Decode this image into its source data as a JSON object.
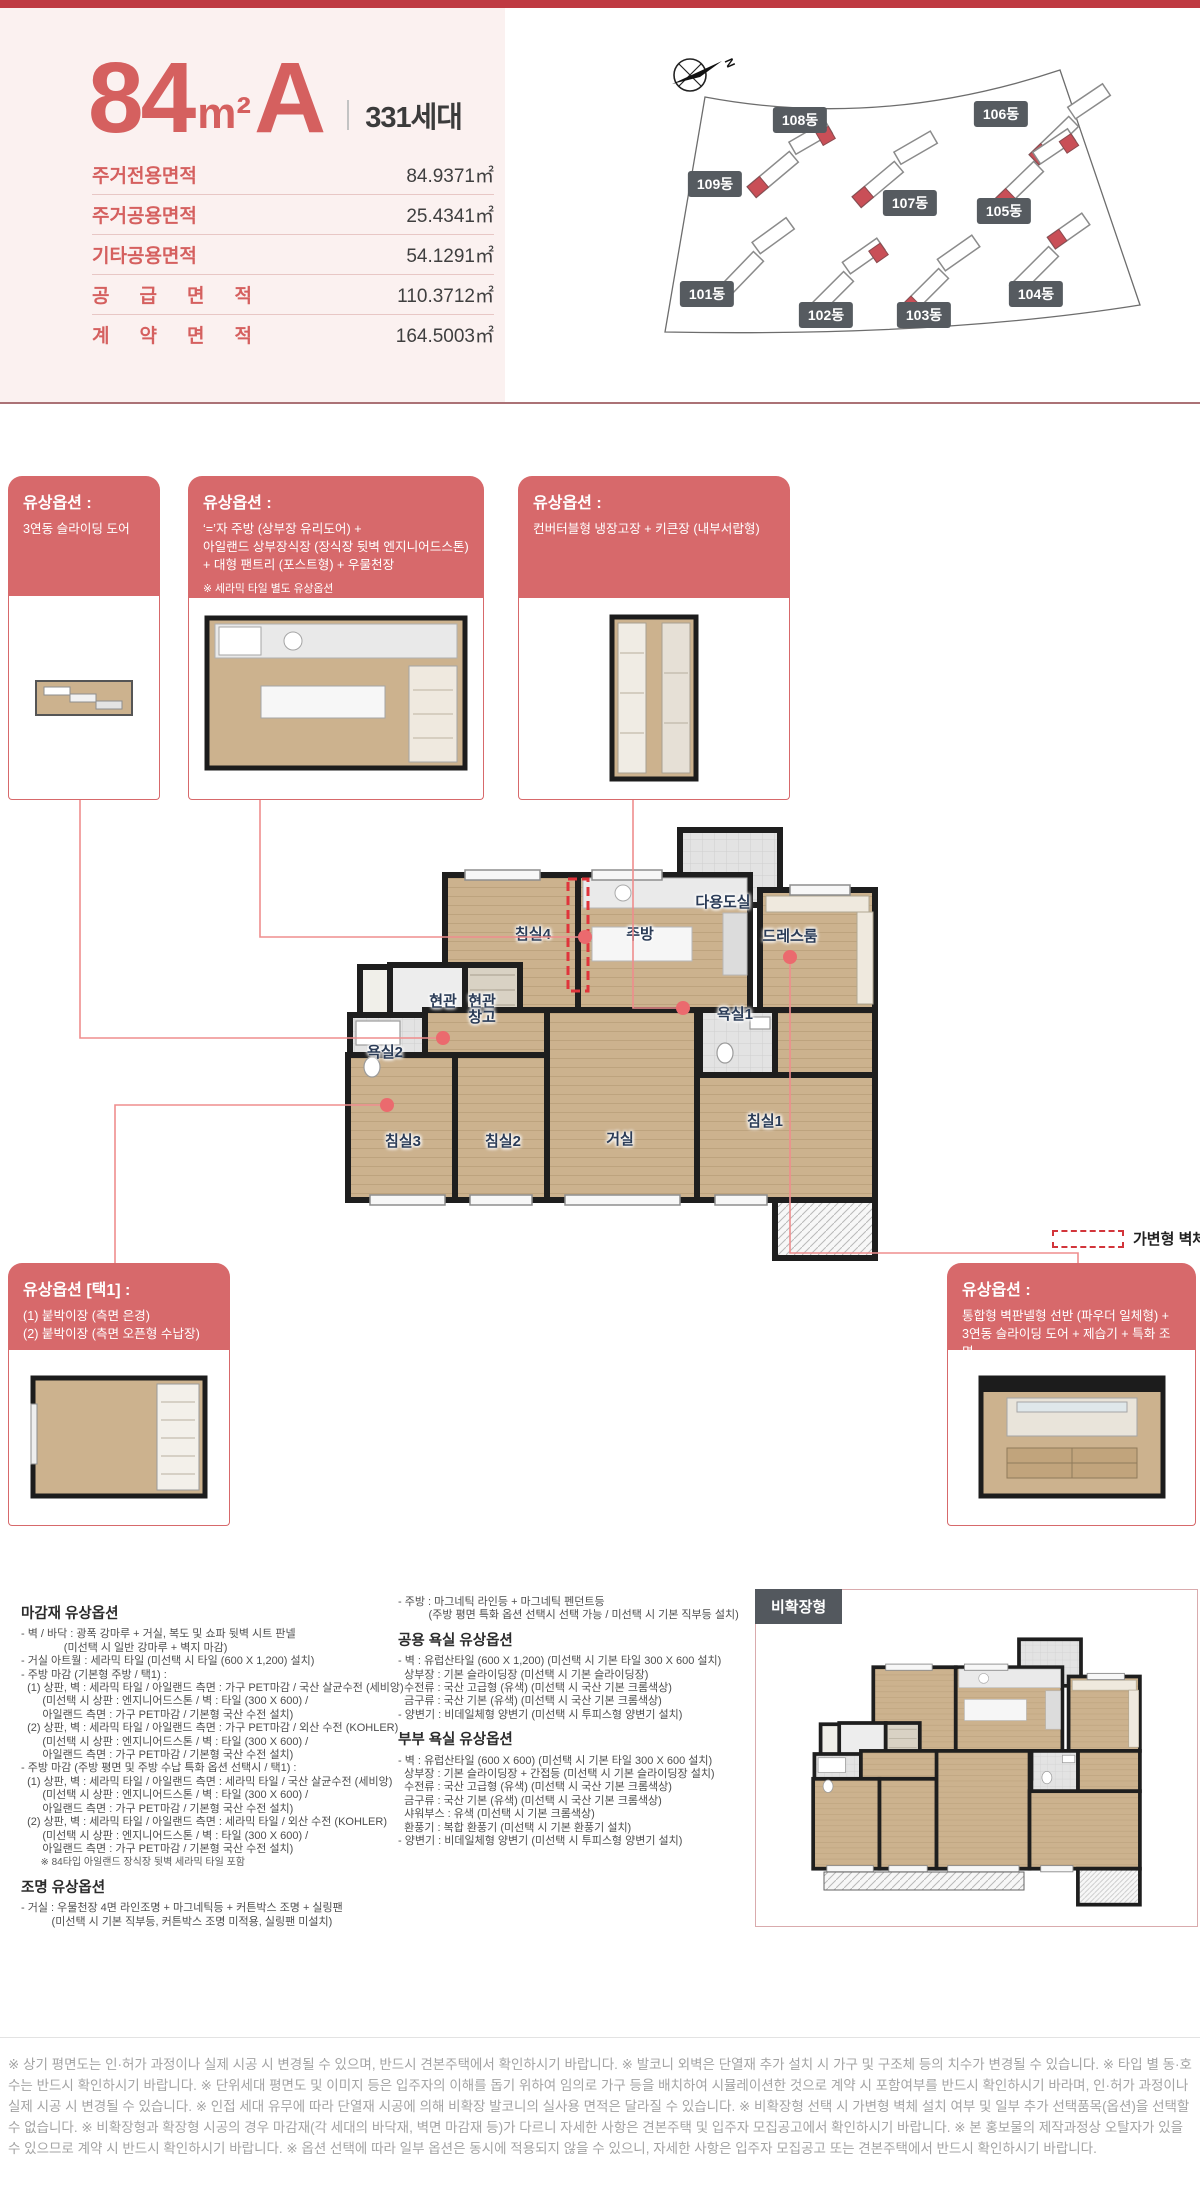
{
  "page": {
    "top_bar_color": "#bf3a42",
    "panel_bg": "#fbf1f0",
    "accent": "#d7696b"
  },
  "header": {
    "type_number": "84",
    "type_unit": "m²",
    "type_variant": "A",
    "households": "331세대",
    "area_rows": [
      {
        "label": "주거전용면적",
        "value": "84.9371㎡"
      },
      {
        "label": "주거공용면적",
        "value": "25.4341㎡"
      },
      {
        "label": "기타공용면적",
        "value": "54.1291㎡"
      },
      {
        "label": "공 급 면 적",
        "value": "110.3712㎡"
      },
      {
        "label": "계 약 면 적",
        "value": "164.5003㎡"
      }
    ]
  },
  "site_plan": {
    "compass_label": "N",
    "building_labels": [
      {
        "label": "108동",
        "x": 800,
        "y": 120
      },
      {
        "label": "106동",
        "x": 1001,
        "y": 114
      },
      {
        "label": "109동",
        "x": 715,
        "y": 184
      },
      {
        "label": "107동",
        "x": 910,
        "y": 203
      },
      {
        "label": "105동",
        "x": 1004,
        "y": 211
      },
      {
        "label": "101동",
        "x": 707,
        "y": 294
      },
      {
        "label": "102동",
        "x": 826,
        "y": 315
      },
      {
        "label": "103동",
        "x": 924,
        "y": 315
      },
      {
        "label": "104동",
        "x": 1036,
        "y": 294
      }
    ]
  },
  "callouts": {
    "box1": {
      "title": "유상옵션 :",
      "lines": [
        "3연동 슬라이딩 도어"
      ]
    },
    "box2": {
      "title": "유상옵션 :",
      "lines": [
        "‘=’자 주방 (상부장 유리도어) +",
        "아일랜드 상부장식장 (장식장 뒷벽 엔지니어드스톤)",
        "+ 대형 팬트리 (포스트형) + 우물천장"
      ],
      "note": "※ 세라믹 타일 별도 유상옵션"
    },
    "box3": {
      "title": "유상옵션 :",
      "lines": [
        "컨버터블형 냉장고장 + 키큰장 (내부서랍형)"
      ]
    },
    "bottom_left": {
      "title": "유상옵션 [택1] :",
      "lines": [
        "(1) 붙박이장 (측면 은경)",
        "(2) 붙박이장 (측면 오픈형 수납장)"
      ]
    },
    "bottom_right": {
      "title": "유상옵션 :",
      "lines": [
        "통합형 벽판넬형 선반 (파우더 일체형) +",
        "3연동 슬라이딩 도어 + 제습기 + 특화 조명"
      ]
    }
  },
  "floor_plan": {
    "legend_label": "가변형 벽체",
    "room_labels": [
      {
        "label": "침실4",
        "x": 533,
        "y": 935
      },
      {
        "label": "주방",
        "x": 640,
        "y": 935
      },
      {
        "label": "다용도실",
        "x": 723,
        "y": 903
      },
      {
        "label": "드레스룸",
        "x": 790,
        "y": 937
      },
      {
        "label": "현관",
        "x": 443,
        "y": 1002
      },
      {
        "label": "현관\n창고",
        "x": 482,
        "y": 1010
      },
      {
        "label": "욕실1",
        "x": 735,
        "y": 1015
      },
      {
        "label": "욕실2",
        "x": 385,
        "y": 1053
      },
      {
        "label": "침실3",
        "x": 403,
        "y": 1142
      },
      {
        "label": "침실2",
        "x": 503,
        "y": 1142
      },
      {
        "label": "거실",
        "x": 620,
        "y": 1140
      },
      {
        "label": "침실1",
        "x": 765,
        "y": 1122
      }
    ]
  },
  "non_expanded": {
    "badge": "비확장형"
  },
  "options": {
    "left": [
      {
        "cls": "h",
        "text": "마감재 유상옵션"
      },
      {
        "cls": "l",
        "text": "- 벽 / 바닥 : 광폭 강마루 + 거실, 복도 및 쇼파 뒷벽 시트 판넬"
      },
      {
        "cls": "l",
        "text": "              (미선택 시 일반 강마루 + 벽지 마감)"
      },
      {
        "cls": "l",
        "text": "- 거실 아트월 : 세라믹 타일 (미선택 시 타일 (600 X 1,200) 설치)"
      },
      {
        "cls": "l",
        "text": "- 주방 마감 (기본형 주방 / 택1) :"
      },
      {
        "cls": "l",
        "text": "  (1) 상판, 벽 : 세라믹 타일 / 아일랜드 측면 : 가구 PET마감 / 국산 살균수전 (세비앙)"
      },
      {
        "cls": "l",
        "text": "       (미선택 시 상판 : 엔지니어드스톤 / 벽 : 타일 (300 X 600) /"
      },
      {
        "cls": "l",
        "text": "       아일랜드 측면 : 가구 PET마감 / 기본형 국산 수전 설치)"
      },
      {
        "cls": "l",
        "text": "  (2) 상판, 벽 : 세라믹 타일 / 아일랜드 측면 : 가구 PET마감 / 외산 수전 (KOHLER)"
      },
      {
        "cls": "l",
        "text": "       (미선택 시 상판 : 엔지니어드스톤 / 벽 : 타일 (300 X 600) /"
      },
      {
        "cls": "l",
        "text": "       아일랜드 측면 : 가구 PET마감 / 기본형 국산 수전 설치)"
      },
      {
        "cls": "l",
        "text": "- 주방 마감 (주방 평면 및 주방 수납 특화 옵션 선택시 / 택1) :"
      },
      {
        "cls": "l",
        "text": "  (1) 상판, 벽 : 세라믹 타일 / 아일랜드 측면 : 세라믹 타일 / 국산 살균수전 (세비앙)"
      },
      {
        "cls": "l",
        "text": "       (미선택 시 상판 : 엔지니어드스톤 / 벽 : 타일 (300 X 600) /"
      },
      {
        "cls": "l",
        "text": "       아일랜드 측면 : 가구 PET마감 / 기본형 국산 수전 설치)"
      },
      {
        "cls": "l",
        "text": "  (2) 상판, 벽 : 세라믹 타일 / 아일랜드 측면 : 세라믹 타일 / 외산 수전 (KOHLER)"
      },
      {
        "cls": "l",
        "text": "       (미선택 시 상판 : 엔지니어드스톤 / 벽 : 타일 (300 X 600) /"
      },
      {
        "cls": "l",
        "text": "       아일랜드 측면 : 가구 PET마감 / 기본형 국산 수전 설치)"
      },
      {
        "cls": "n",
        "text": "       ※ 84타입 아일랜드 장식장 뒷벽 세라믹 타일 포함"
      },
      {
        "cls": "h",
        "text": "조명 유상옵션"
      },
      {
        "cls": "l",
        "text": "- 거실 : 우물천장 4면 라인조명 + 마그네틱등 + 커튼박스 조명 + 실링팬"
      },
      {
        "cls": "l",
        "text": "          (미선택 시 기본 직부등, 커튼박스 조명 미적용, 실링팬 미설치)"
      }
    ],
    "right": [
      {
        "cls": "l",
        "text": "- 주방 : 마그네틱 라인등 + 마그네틱 펜던트등"
      },
      {
        "cls": "l",
        "text": "          (주방 평면 특화 옵션 선택시 선택 가능 / 미선택 시 기본 직부등 설치)"
      },
      {
        "cls": "h",
        "text": "공용 욕실 유상옵션"
      },
      {
        "cls": "l",
        "text": "- 벽 : 유럽산타일 (600 X 1,200) (미선택 시 기본 타일 300 X 600 설치)"
      },
      {
        "cls": "l",
        "text": "  상부장 : 기본 슬라이딩장 (미선택 시 기본 슬라이딩장)"
      },
      {
        "cls": "l",
        "text": "  수전류 : 국산 고급형 (유색) (미선택 시 국산 기본 크롬색상)"
      },
      {
        "cls": "l",
        "text": "  금구류 : 국산 기본 (유색) (미선택 시 국산 기본 크롬색상)"
      },
      {
        "cls": "l",
        "text": "- 양변기 : 비데일체형 양변기 (미선택 시 투피스형 양변기 설치)"
      },
      {
        "cls": "h",
        "text": "부부 욕실 유상옵션"
      },
      {
        "cls": "l",
        "text": "- 벽 : 유럽산타일 (600 X 600) (미선택 시 기본 타일 300 X 600 설치)"
      },
      {
        "cls": "l",
        "text": "  상부장 : 기본 슬라이딩장 + 간접등 (미선택 시 기본 슬라이딩장 설치)"
      },
      {
        "cls": "l",
        "text": "  수전류 : 국산 고급형 (유색) (미선택 시 국산 기본 크롬색상)"
      },
      {
        "cls": "l",
        "text": "  금구류 : 국산 기본 (유색) (미선택 시 국산 기본 크롬색상)"
      },
      {
        "cls": "l",
        "text": "  샤워부스 : 유색 (미선택 시 기본 크롬색상)"
      },
      {
        "cls": "l",
        "text": "  환풍기 : 복합 환풍기 (미선택 시 기본 환풍기 설치)"
      },
      {
        "cls": "l",
        "text": "- 양변기 : 비데일체형 양변기 (미선택 시 투피스형 양변기 설치)"
      }
    ]
  },
  "footer": {
    "disclaimer": "※ 상기 평면도는 인·허가 과정이나 실제 시공 시 변경될 수 있으며, 반드시 견본주택에서 확인하시기 바랍니다. ※ 발코니 외벽은 단열재 추가 설치 시 가구 및 구조체 등의 치수가 변경될 수 있습니다. ※ 타입 별 동·호 수는 반드시 확인하시기 바랍니다. ※ 단위세대 평면도 및 이미지 등은 입주자의 이해를 돕기 위하여 임의로 가구 등을 배치하여 시뮬레이션한 것으로 계약 시 포함여부를 반드시 확인하시기 바라며, 인·허가 과정이나 실제 시공 시 변경될 수 있습니다. ※ 인접 세대 유무에 따라 단열재 시공에 의해 비확장 발코니의 실사용 면적은 달라질 수 있습니다. ※ 비확장형 선택 시 가변형 벽체 설치 여부 및 일부 추가 선택품목(옵션)을 선택할 수 없습니다. ※ 비확장형과 확장형 시공의 경우 마감재(각 세대의 바닥재, 벽면 마감재 등)가 다르니 자세한 사항은 견본주택 및 입주자 모집공고에서 확인하시기 바랍니다. ※ 본 홍보물의 제작과정상 오탈자가 있을 수 있으므로 계약 시 반드시 확인하시기 바랍니다. ※ 옵션 선택에 따라 일부 옵션은 동시에 적용되지 않을 수 있으니, 자세한 사항은 입주자 모집공고 또는 견본주택에서 반드시 확인하시기 바랍니다."
  }
}
